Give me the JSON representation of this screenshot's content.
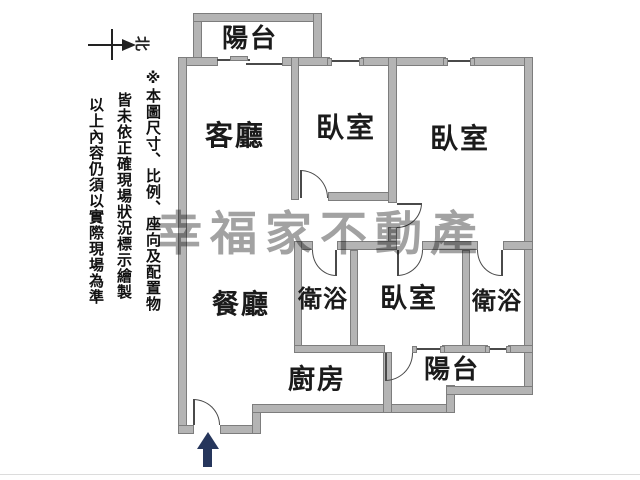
{
  "compass": {
    "label": "北"
  },
  "disclaimer": {
    "col1": "※本圖尺寸、比例、座向及配置物",
    "col2": "皆未依正確現場狀況標示繪製",
    "col3": "以上內容仍須以實際現場為準"
  },
  "watermark": {
    "text": "幸福家不動產",
    "color": "#a2a2a2"
  },
  "rooms": [
    {
      "id": "balcony-top",
      "label": "陽台"
    },
    {
      "id": "living-room",
      "label": "客廳"
    },
    {
      "id": "bedroom-1",
      "label": "臥室"
    },
    {
      "id": "bedroom-2",
      "label": "臥室"
    },
    {
      "id": "dining-room",
      "label": "餐廳"
    },
    {
      "id": "bathroom-1",
      "label": "衛浴"
    },
    {
      "id": "bedroom-3",
      "label": "臥室"
    },
    {
      "id": "bathroom-2",
      "label": "衛浴"
    },
    {
      "id": "kitchen",
      "label": "廚房"
    },
    {
      "id": "balcony-bottom",
      "label": "陽台"
    }
  ],
  "colors": {
    "wall_fill": "#b4b4b4",
    "wall_edge": "#7d7d7d",
    "line": "#4a4a4a",
    "entry_arrow": "#26365c",
    "text": "#1b1b1b"
  }
}
